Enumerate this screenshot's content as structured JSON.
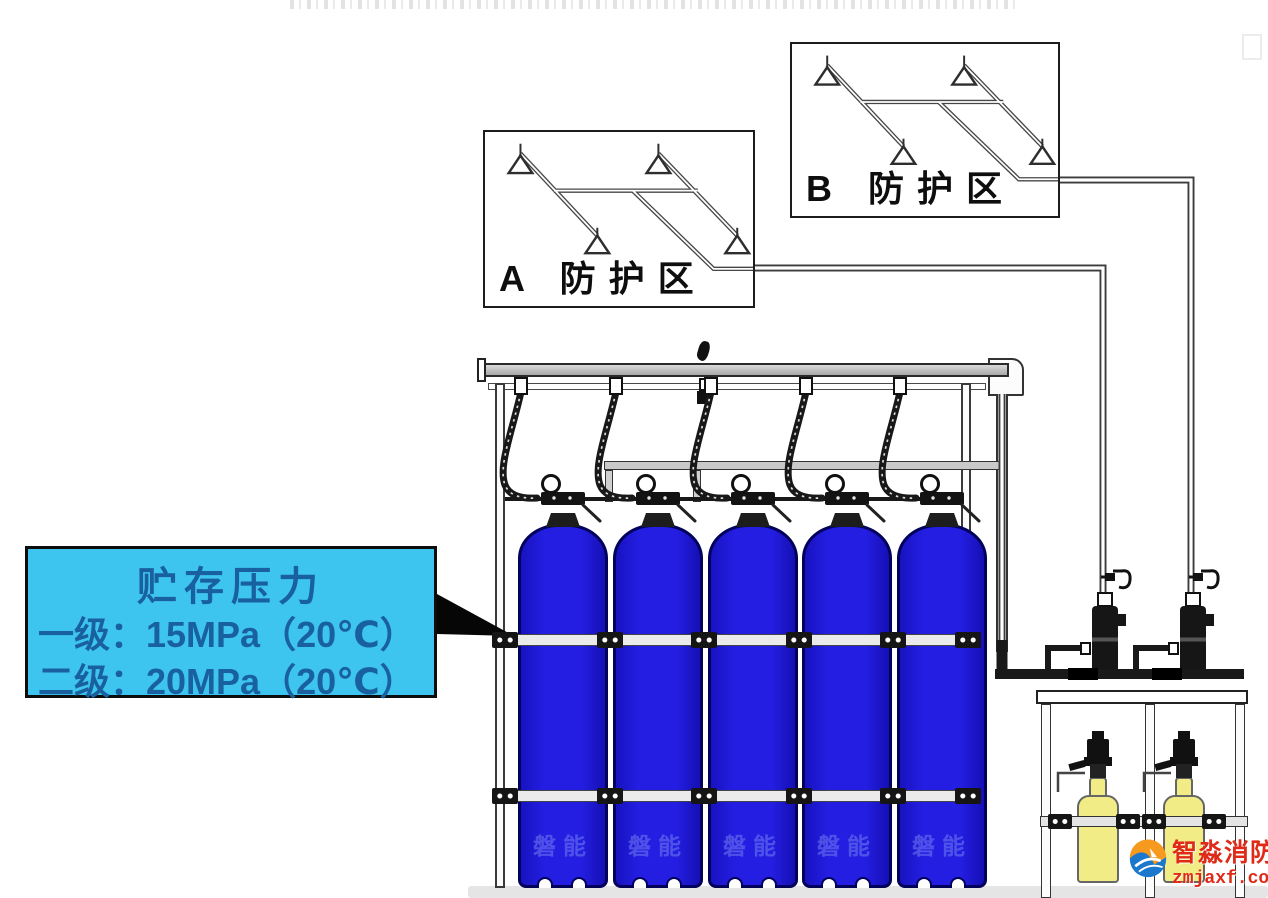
{
  "canvas": {
    "width": 1268,
    "height": 898,
    "background": "#ffffff"
  },
  "zones": {
    "a": {
      "label": "A 防护区",
      "nozzle_count": 4
    },
    "b": {
      "label": "B 防护区",
      "nozzle_count": 4
    }
  },
  "callout": {
    "title": "贮存压力",
    "line1": "一级：15MPa（20℃）",
    "line2": "二级：20MPa（20℃）"
  },
  "cylinders": {
    "count": 5,
    "watermark": "磐能"
  },
  "starter_cylinders": {
    "count": 2
  },
  "logo": {
    "name": "智淼消防",
    "site": "zmjaxf.com"
  },
  "colors": {
    "callout_bg": "#3ec5ef",
    "callout_text": "#19619e",
    "cylinder_blue": "#1f18d8",
    "cylinder_outline": "#02025a",
    "starter_yellow": "#f1ec85",
    "logo_red": "#e02a18",
    "pipe_dark": "#3d3d3d"
  }
}
